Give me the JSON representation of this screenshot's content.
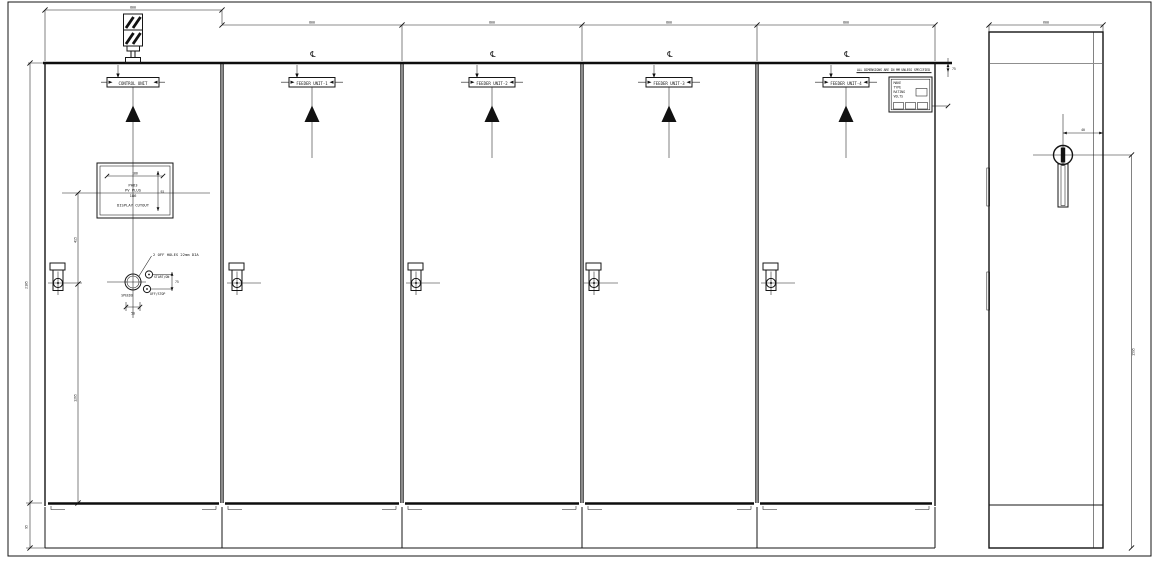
{
  "note": {
    "text": "ALL DIMENSIONS ARE IN MM UNLESS SPECIFIED"
  },
  "symbols": {
    "centerline": "℄"
  },
  "panels": {
    "labels": [
      "CONTROL UNIT",
      "FEEDER UNIT-1",
      "FEEDER UNIT-2",
      "FEEDER UNIT-3",
      "FEEDER UNIT-4"
    ],
    "width_dims": [
      "800",
      "800",
      "800",
      "800",
      "800"
    ]
  },
  "front_dims": {
    "door_height": "2105",
    "plinth_height": "95",
    "cutout_offset_top": "415",
    "cutout_offset_bottom": "1265",
    "top_right": "75"
  },
  "cutout": {
    "lines": [
      "PH63",
      "PV PLUS",
      "186",
      "DISPLAY CUTOUT"
    ],
    "width_dim": "186",
    "height_dim": "92"
  },
  "controls": {
    "holes_note": "2 OFF HOLES 22mm DIA",
    "btn_top": "START/ON",
    "btn_bottom": "OFF/STOP",
    "meter": "SPEEDO",
    "dim_vertical": "75",
    "dim_horizontal": "50"
  },
  "side_view": {
    "depth_dim": "600",
    "handle_offset_dim": "40",
    "height_dim": "1595"
  },
  "nameplate": {
    "rows": [
      "MAKE",
      "TYPE",
      "RATING",
      "VOLTS"
    ]
  }
}
